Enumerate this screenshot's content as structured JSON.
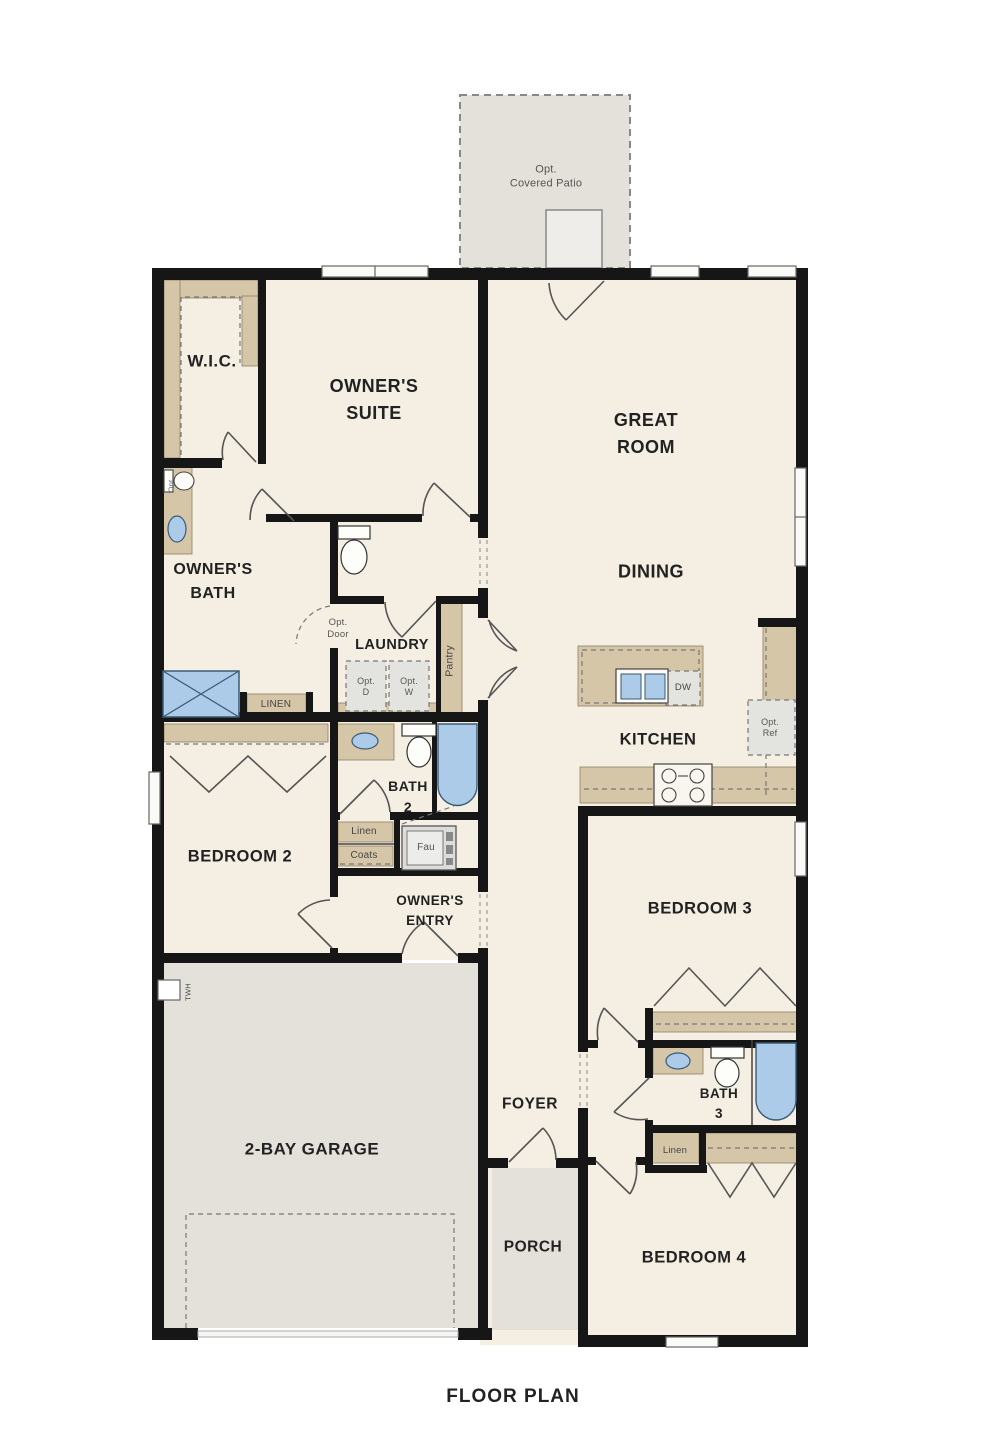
{
  "title": "FLOOR PLAN",
  "colors": {
    "floor": "#f4efe2",
    "hard_surface": "#e4e1da",
    "cabinetry": "#d6c6a8",
    "wall": "#161616",
    "fixture_blue": "#abcbe9",
    "dashed_box": "#e3e3e0"
  },
  "labels": {
    "patio": "Opt.\nCovered Patio",
    "wic": "W.I.C.",
    "owners_suite": "OWNER'S\nSUITE",
    "great_room": "GREAT\nROOM",
    "owners_bath": "OWNER'S\nBATH",
    "dining": "DINING",
    "opt_door": "Opt.\nDoor",
    "laundry": "LAUNDRY",
    "pantry": "Pantry",
    "opt_d": "Opt.\nD",
    "opt_w": "Opt.\nW",
    "dw": "DW",
    "opt_ref": "Opt.\nRef",
    "kitchen": "KITCHEN",
    "linen_owners": "LINEN",
    "bath2": "BATH\n2",
    "linen_hall": "Linen",
    "coats": "Coats",
    "fau": "Fau",
    "bedroom2": "BEDROOM 2",
    "owners_entry": "OWNER'S\nENTRY",
    "bedroom3": "BEDROOM 3",
    "bath3": "BATH\n3",
    "linen3": "Linen",
    "opt_toilet": "Opt",
    "twh": "TWH",
    "garage": "2-BAY GARAGE",
    "foyer": "FOYER",
    "porch": "PORCH",
    "bedroom4": "BEDROOM 4",
    "title": "FLOOR PLAN"
  }
}
